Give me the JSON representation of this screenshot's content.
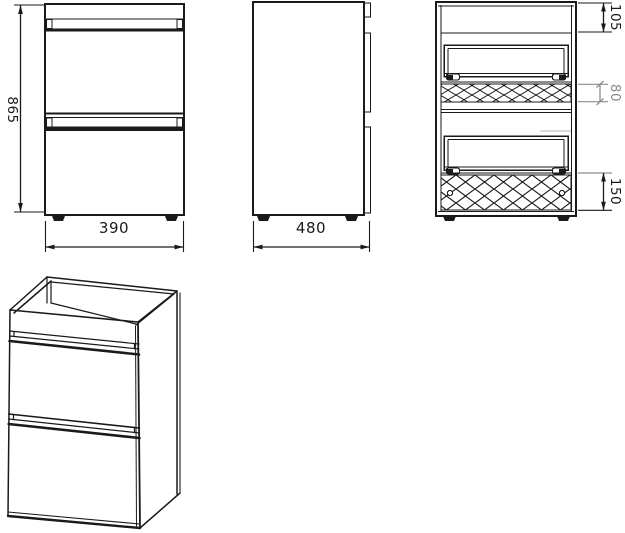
{
  "drawing": {
    "title": "vanity-cabinet-technical-drawing",
    "front_view": {
      "height_mm": "865",
      "width_mm": "390"
    },
    "side_view": {
      "depth_mm": "480"
    },
    "section_view": {
      "top_section_mm": "105",
      "mid_section_mm": "80",
      "bottom_section_mm": "150"
    }
  },
  "colors": {
    "line": "#1a1a1a",
    "dim_secondary": "#8c8c8c",
    "background": "#ffffff"
  }
}
